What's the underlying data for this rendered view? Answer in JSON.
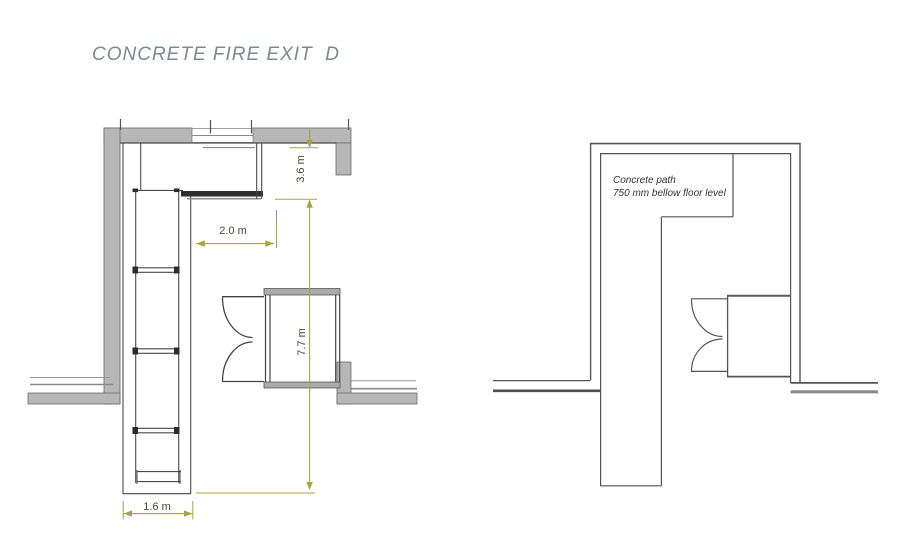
{
  "title": "CONCRETE FIRE EXIT  D",
  "colors": {
    "background": "#ffffff",
    "title_text": "#7f898b",
    "wall_fill": "#b7b7b7",
    "plan_line": "#4a4a4a",
    "dimension_line": "#a9a53b",
    "dimension_text": "#4b4636",
    "annotation_text": "#333333"
  },
  "left_plan": {
    "dimensions": {
      "top_height": "3.6 m",
      "passage_width": "2.0 m",
      "total_height": "7.7 m",
      "stair_width": "1.6 m"
    }
  },
  "right_plan": {
    "annotation": {
      "line1": "Concrete path",
      "line2": "750 mm bellow floor level"
    }
  }
}
